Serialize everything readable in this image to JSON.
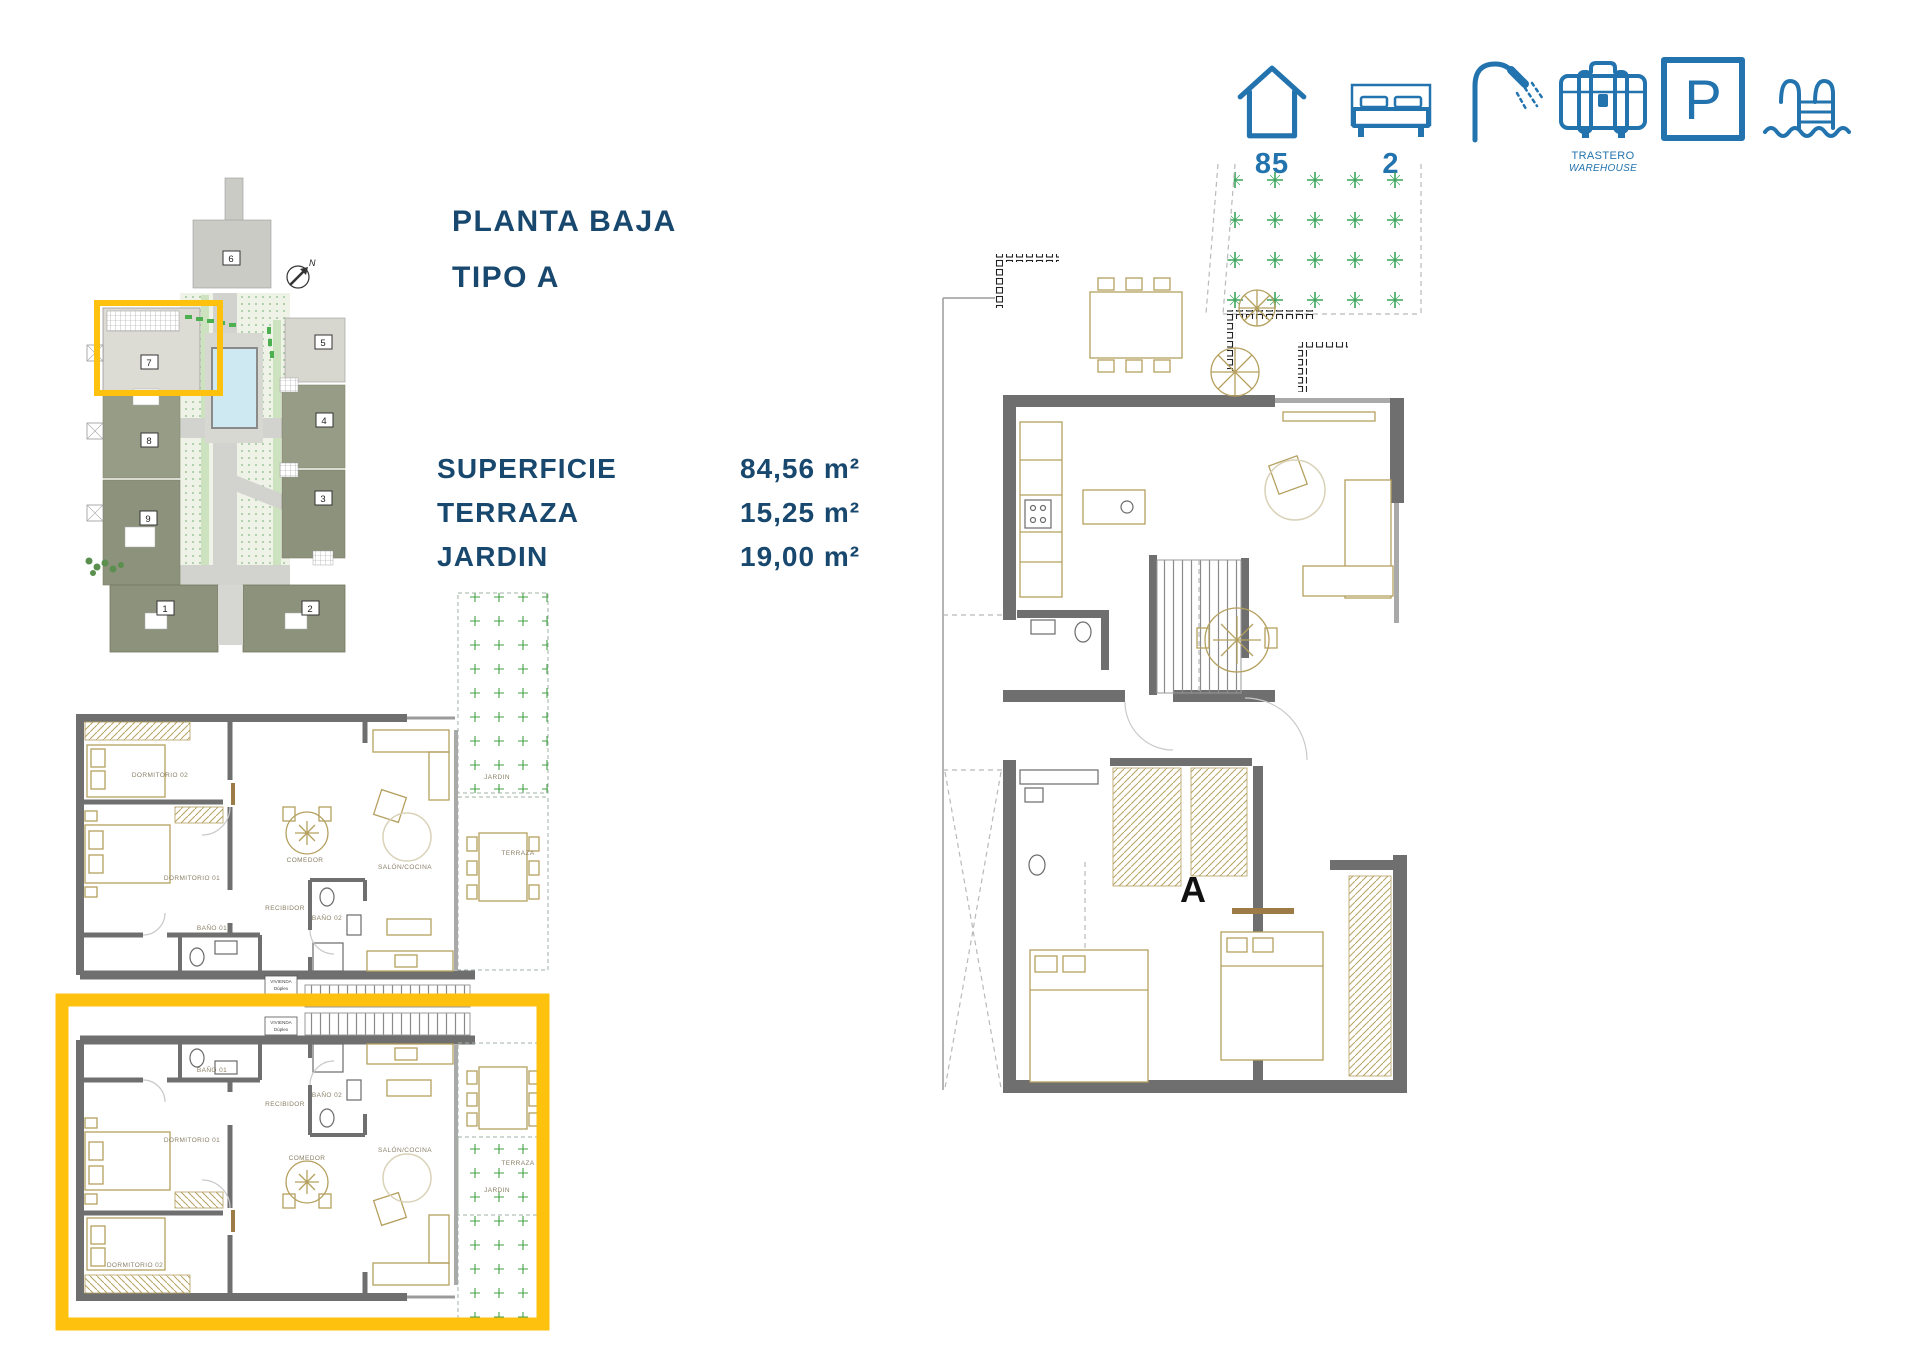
{
  "colors": {
    "navy": "#19486f",
    "icon_blue": "#2273ae",
    "orange": "#FEC10D",
    "wall_gray": "#6f6f6f",
    "furniture_tan": "#b5a05f",
    "green_cross": "#3aa35c",
    "pool_blue": "#cfe9f2",
    "site_olive": "#8f947c",
    "site_olive_dark": "#848a6e",
    "site_light": "#d9d8d0"
  },
  "header_icons": {
    "house_value": "85",
    "bed_value": "2",
    "shower_value": "2",
    "trastero_label": "TRASTERO",
    "trastero_label_en": "WAREHOUSE",
    "parking_letter": "P"
  },
  "title": {
    "line1": "PLANTA BAJA",
    "line2": "TIPO A"
  },
  "specs": {
    "rows": [
      {
        "label": "SUPERFICIE",
        "value": "84,56 m²"
      },
      {
        "label": "TERRAZA",
        "value": "15,25 m²"
      },
      {
        "label": "JARDIN",
        "value": "19,00 m²"
      }
    ]
  },
  "site_plan": {
    "north": "N",
    "units": [
      "1",
      "2",
      "3",
      "4",
      "5",
      "6",
      "7",
      "8",
      "9"
    ]
  },
  "rooms": {
    "dorm01": "DORMITORIO 01",
    "dorm02": "DORMITORIO 02",
    "bano01": "BAÑO 01",
    "bano02": "BAÑO 02",
    "recibidor": "RECIBIDOR",
    "comedor": "COMEDOR",
    "salon": "SALÓN/COCINA",
    "terraza": "TERRAZA",
    "jardin": "JARDIN"
  },
  "tags": {
    "vivienda": "VIVIENDA",
    "tipo": "Dúplex"
  },
  "large_plan": {
    "section": "A"
  }
}
